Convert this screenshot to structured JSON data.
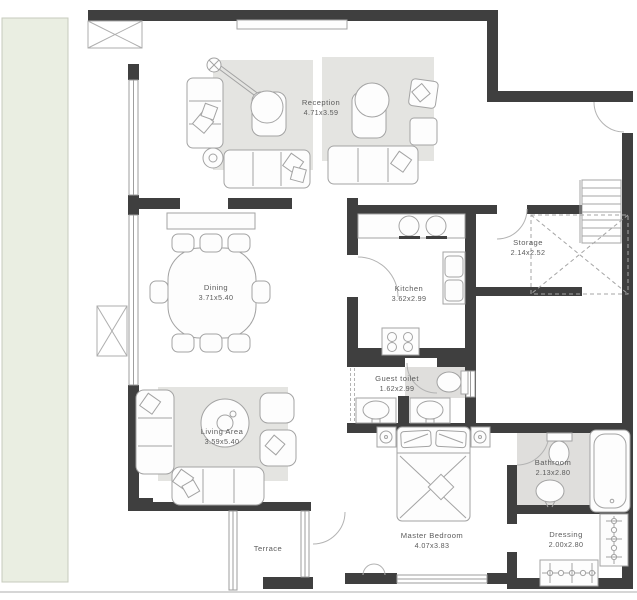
{
  "plan": {
    "title": "apartment-floor-plan",
    "rooms": [
      {
        "name": "Reception",
        "dims": "4.71x3.59"
      },
      {
        "name": "Dining",
        "dims": "3.71x5.40"
      },
      {
        "name": "Kitchen",
        "dims": "3.62x2.99"
      },
      {
        "name": "Storage",
        "dims": "2.14x2.52"
      },
      {
        "name": "Guest toilet",
        "dims": "1.62x2.99"
      },
      {
        "name": "Living Area",
        "dims": "3.59x5.40"
      },
      {
        "name": "Master Bedroom",
        "dims": "4.07x3.83"
      },
      {
        "name": "Bathroom",
        "dims": "2.13x2.80"
      },
      {
        "name": "Dressing",
        "dims": "2.00x2.80"
      },
      {
        "name": "Terrace",
        "dims": ""
      }
    ],
    "colors": {
      "wall": "#3f3f3f",
      "floor": "#ffffff",
      "rug": "#e4e4e1",
      "wet_floor": "#dfdedc",
      "garden_strip": "#eaeee2",
      "furniture_line": "#a3a3a3",
      "label_text": "#5c5c5c"
    }
  }
}
